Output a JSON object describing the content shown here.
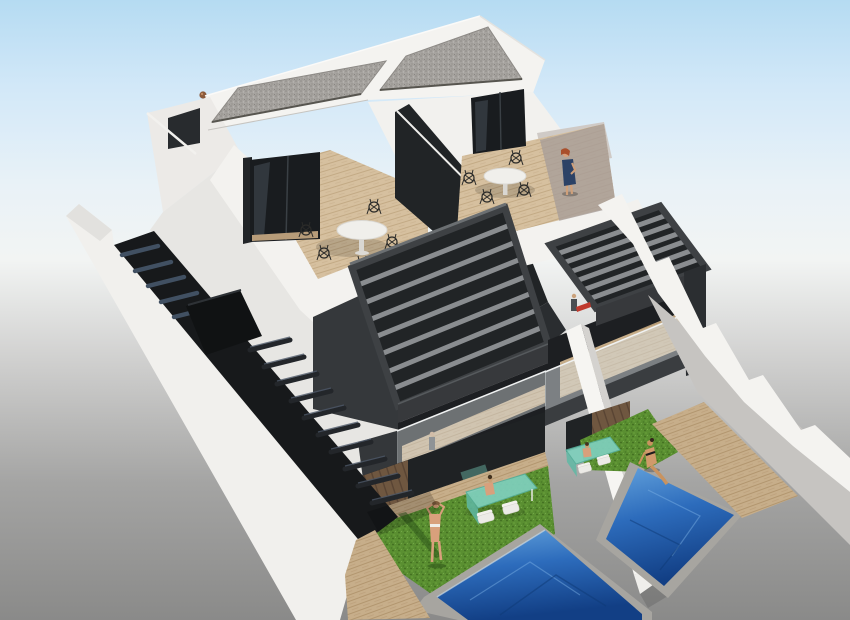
{
  "scene": {
    "title": "Aerial 3D render of two new-build semi-detached villas",
    "type": "architectural-visualization",
    "view": "aerial three-quarter view from the south-west corner",
    "time_of_day": "bright midday sun, soft sky gradient fading to grey ground",
    "description": "Photorealistic 3D architectural rendering of two modern semi-detached villas. Flat gravel roofs sit over white penthouse rooms that open onto wooden roof terraces with round bistro tables and black wire chairs; a red-haired woman in a blue dress stands on the right terrace. Below, an anthracite louvered pergola shades a first-floor balcony with a glass balustrade. At ground level each villa has a private garden with artificial lawn, a green glass dining table with white chairs, a timber deck and a private blue pool; one woman in a bikini stands on the left lawn and another sits at the right pool edge with her feet in the water. An external dark staircase with a white parapet descends along the left side wall."
  },
  "building": {
    "villas": 2,
    "storeys": 3,
    "roof": "flat gravel roof",
    "finish": "white render with anthracite pergola and dark glazing",
    "features": [
      "rooftop terraces",
      "louvered pergolas",
      "glass balustrade balcony",
      "private pools",
      "artificial lawns",
      "external side staircase",
      "stepped white boundary walls"
    ]
  },
  "amenities": {
    "pools": 2,
    "rooftop_terraces": 2,
    "pergolas": 2,
    "gardens": 2,
    "roof_dining_sets": 2,
    "garden_dining_sets": 2,
    "external_staircases": 1
  },
  "figures": [
    {
      "name": "woman-blue-dress",
      "location": "right rooftop terrace"
    },
    {
      "name": "woman-bikini-standing",
      "location": "left garden lawn"
    },
    {
      "name": "woman-bikini-seated",
      "location": "right pool edge, feet in water"
    },
    {
      "name": "person-at-left-garden-table",
      "location": "left garden dining table"
    },
    {
      "name": "person-at-right-garden-table",
      "location": "right garden dining table"
    },
    {
      "name": "resident-on-balcony-1",
      "location": "first-floor balcony"
    },
    {
      "name": "resident-on-balcony-2",
      "location": "first-floor balcony"
    },
    {
      "name": "resident-under-left-pergola",
      "location": "left first-floor balcony"
    }
  ],
  "palette": {
    "sky_top": "#b5dbf2",
    "sky_upper": "#d2e8f8",
    "sky_mid": "#f2f4f3",
    "ground_grey": "#8a8a89",
    "wall_white": "#f4f3f0",
    "wall_shade": "#e7e6e3",
    "anthracite": "#35383b",
    "anthracite_deep": "#212426",
    "slat_grey": "#8a8d90",
    "glass_door": "#191c1f",
    "gravel": "#a6a39f",
    "wood_deck": "#d6c09f",
    "wood_balcony": "#c7ae8a",
    "wood_planks": "#6f5740",
    "grass": "#5a8f31",
    "pool_light": "#63a2dc",
    "pool_deep": "#123f85",
    "glass_table": "#7fd0bd",
    "stair_dark": "#17191b",
    "tread_sheen": "#415062",
    "skin": "#d8a07c",
    "dress_blue": "#2c4266",
    "hair_red": "#a94f2c",
    "towel_red": "#c03a2e"
  }
}
